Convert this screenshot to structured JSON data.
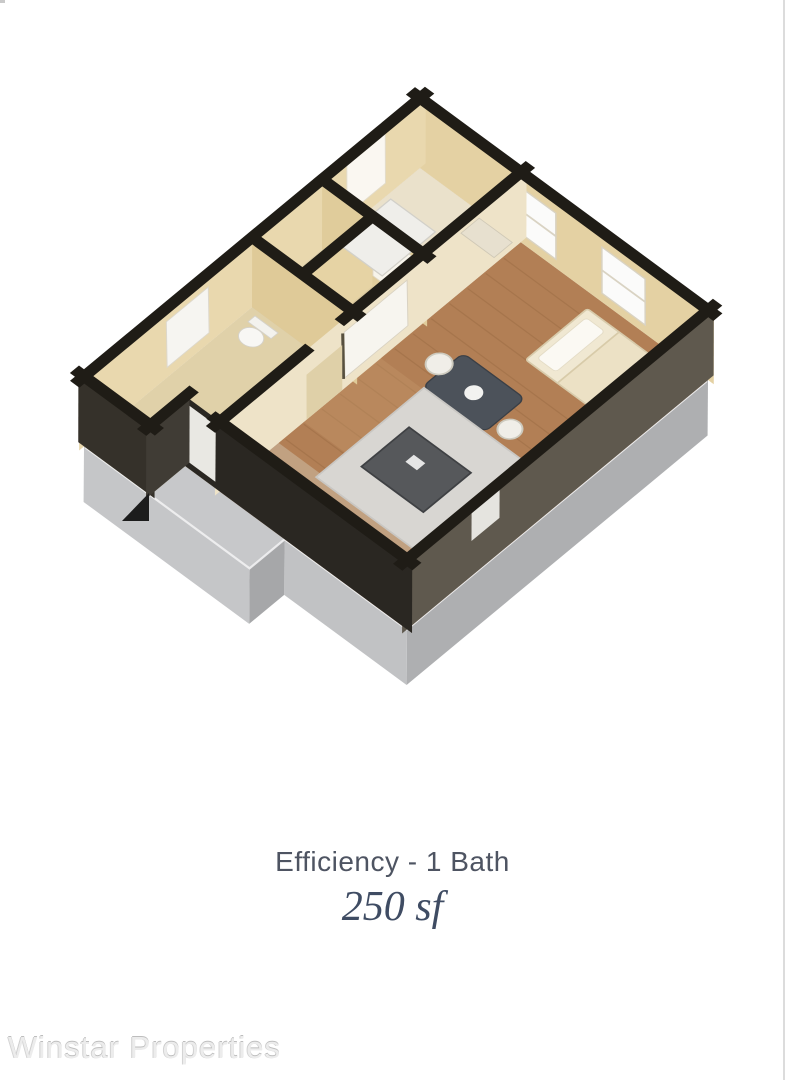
{
  "caption": {
    "unit_type": "Efficiency - 1 Bath",
    "area": "250 sf"
  },
  "watermark": "Winstar Properties",
  "palette": {
    "wall_cap": "#1f1c16",
    "wall_tan": "#e4d1a3",
    "wall_cream": "#eee3c8",
    "wall_exterior_dark": "#2a2722",
    "wall_exterior_east": "#5f594e",
    "wood_floor": "#b27f55",
    "slab_top_gray": "#c7c8ca",
    "slab_side_gray": "#aeafb1",
    "rug": "#d8d6d2",
    "ottoman": "#56585b",
    "dining_table": "#4c525a",
    "bed": "#f0e8d2",
    "caption_text": "#4e5462",
    "area_text": "#3f4c63",
    "watermark_text": "#ececec",
    "background": "#ffffff"
  }
}
